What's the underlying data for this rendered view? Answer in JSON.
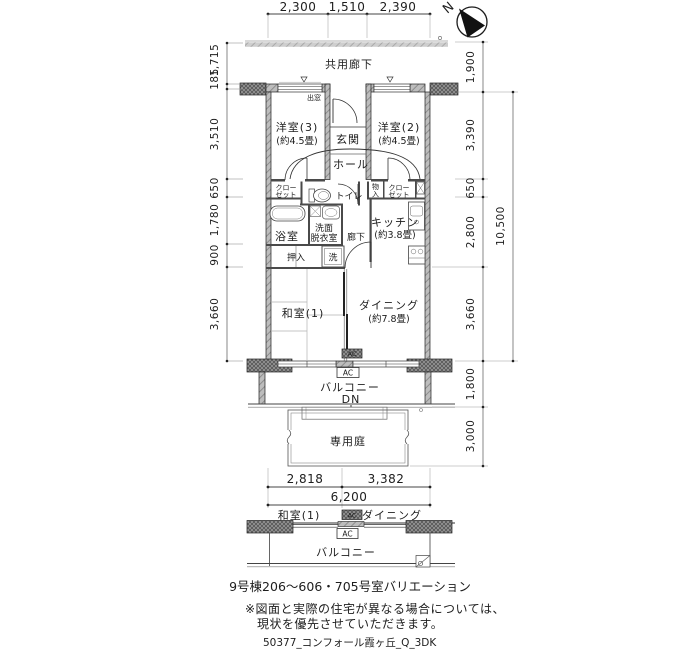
{
  "plan": {
    "north": "N",
    "labels": {
      "common_corridor": "共用廊下",
      "bay_window": "出窓",
      "entrance": "玄関",
      "hall": "ホール",
      "western3": "洋室(3)",
      "western3_size": "(約4.5畳)",
      "western2": "洋室(2)",
      "western2_size": "(約4.5畳)",
      "closet_l1": "クロー",
      "closet_l2": "ゼット",
      "toilet": "トイレ",
      "storage1": "物",
      "storage2": "入",
      "closet_r1": "クロー",
      "closet_r2": "ゼット",
      "bath": "浴室",
      "wash1": "洗面",
      "wash2": "脱衣室",
      "hallway": "廊下",
      "kitchen": "キッチン",
      "kitchen_size": "(約3.8畳)",
      "oshiire": "押入",
      "laundry": "洗",
      "washitsu": "和室(1)",
      "dining": "ダイニング",
      "dining_size": "(約7.8畳)",
      "ac": "AC",
      "balcony": "バルコニー",
      "dn": "DN",
      "garden": "専用庭"
    },
    "dimensions": {
      "top": [
        "2,300",
        "1,510",
        "2,390"
      ],
      "left": [
        "1,715",
        "185",
        "3,510",
        "650",
        "1,780",
        "900",
        "3,660"
      ],
      "right": [
        "1,900",
        "3,390",
        "650",
        "2,800",
        "3,660",
        "1,800",
        "3,000"
      ],
      "right_total": "10,500",
      "bottom": [
        "2,818",
        "3,382"
      ],
      "bottom_total": "6,200"
    }
  },
  "variation": {
    "washitsu": "和室(1)",
    "dining": "ダイニング",
    "ac": "AC",
    "balcony": "バルコニー",
    "caption": "9号棟206〜606・705号室バリエーション"
  },
  "notes": {
    "line1": "※図面と実際の住宅が異なる場合については、",
    "line2": "現状を優先させていただきます。",
    "file_id": "50377_コンフォール霞ヶ丘_Q_3DK"
  }
}
